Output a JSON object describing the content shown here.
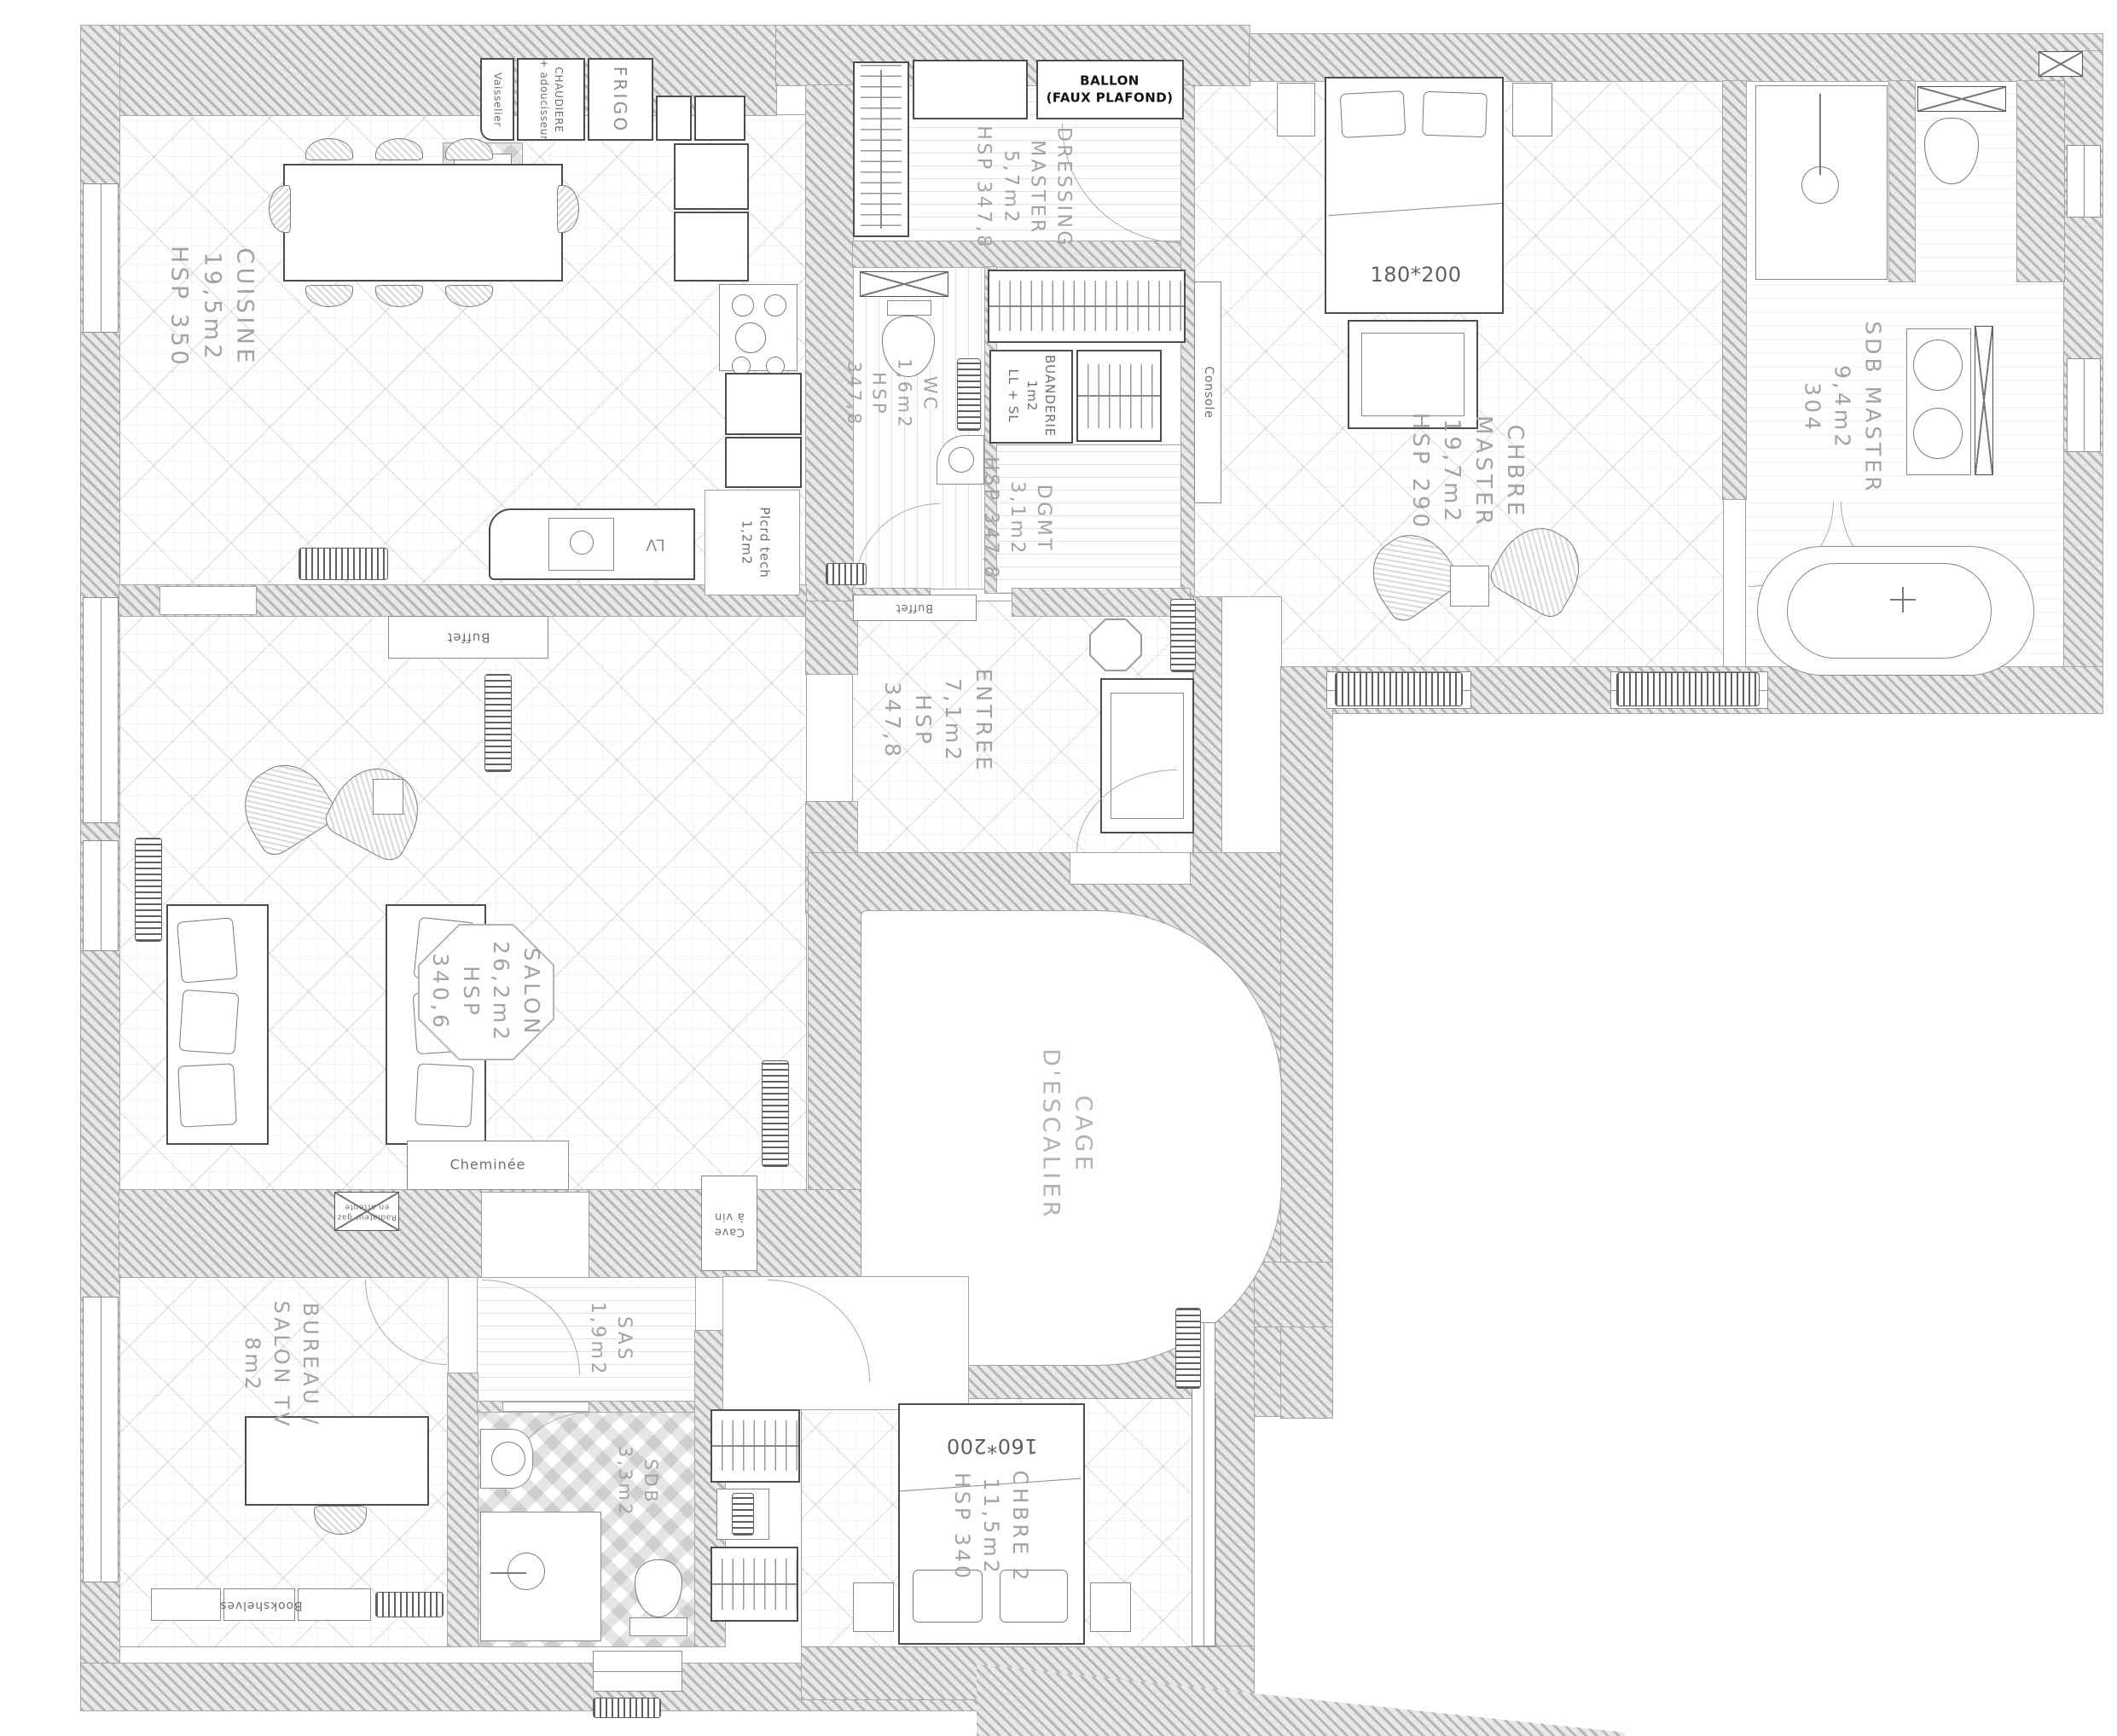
{
  "rooms": {
    "cuisine": {
      "lines": [
        "CUISINE",
        "19,5m2",
        "HSP 350"
      ]
    },
    "dressing": {
      "lines": [
        "DRESSING",
        "MASTER",
        "5,7m2",
        "HSP 347,8"
      ]
    },
    "wc": {
      "lines": [
        "WC",
        "1,6m2",
        "HSP",
        "347,8"
      ]
    },
    "buanderie": {
      "lines": [
        "BUANDERIE",
        "1m2",
        "LL + SL"
      ]
    },
    "dgmt": {
      "lines": [
        "DGMT",
        "3,1m2",
        "HSP 347,8"
      ]
    },
    "chbre_master": {
      "lines": [
        "CHBRE",
        "MASTER",
        "19,7m2",
        "HSP 290"
      ]
    },
    "sdb_master": {
      "lines": [
        "SDB MASTER",
        "9,4m2",
        "304"
      ]
    },
    "entree": {
      "lines": [
        "ENTREE",
        "7,1m2",
        "HSP",
        "347,8"
      ]
    },
    "salon": {
      "lines": [
        "SALON",
        "26,2m2",
        "HSP",
        "340,6"
      ]
    },
    "cage": {
      "lines": [
        "CAGE",
        "D'ESCALIER"
      ]
    },
    "bureau": {
      "lines": [
        "BUREAU /",
        "SALON TV",
        "8m2"
      ]
    },
    "sas": {
      "lines": [
        "SAS",
        "1,9m2"
      ]
    },
    "sdb": {
      "lines": [
        "SDB",
        "3,3m2"
      ]
    },
    "chbre2": {
      "lines": [
        "CHBRE 2",
        "11,5m2",
        "HSP 340"
      ]
    }
  },
  "furniture": {
    "vaisselier": "Vaisselier",
    "chaudiere": {
      "lines": [
        "CHAUDIERE",
        "+ adoucisseur"
      ]
    },
    "frigo": "FRIGO",
    "ballon": {
      "lines": [
        "BALLON",
        "(FAUX PLAFOND)"
      ]
    },
    "lv": "LV",
    "plcrd": {
      "lines": [
        "Plcrd tech",
        "1,2m2"
      ]
    },
    "console": "Console",
    "buffet_salon": "Buffet",
    "buffet_entree": "Buffet",
    "cheminee": "Cheminée",
    "cave": {
      "lines": [
        "Cave",
        "à vin"
      ]
    },
    "bookshelves": "Bookshelves",
    "rad_attente": {
      "lines": [
        "Radiateur gaz",
        "en attente"
      ]
    },
    "bed_master_size": "180*200",
    "bed_2_size": "160*200"
  }
}
